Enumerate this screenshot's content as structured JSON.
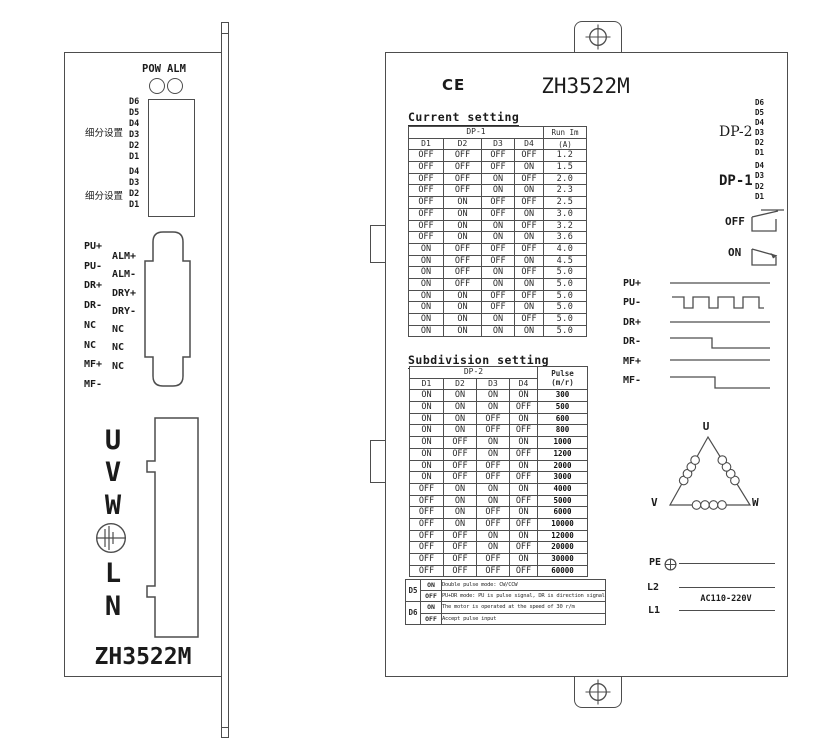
{
  "colors": {
    "line": "#4d4d4d",
    "background": "#ffffff"
  },
  "left_panel": {
    "model": "ZH3522M",
    "led_labels": [
      "POW",
      "ALM"
    ],
    "subdivision_cn": "细分设置",
    "dip1_bits": [
      "D6",
      "D5",
      "D4",
      "D3",
      "D2",
      "D1"
    ],
    "dip2_bits": [
      "D4",
      "D3",
      "D2",
      "D1"
    ],
    "connector_left_pins": [
      "PU+",
      "PU-",
      "DR+",
      "DR-",
      "NC",
      "NC",
      "MF+",
      "MF-"
    ],
    "connector_right_pins": [
      "ALM+",
      "ALM-",
      "DRY+",
      "DRY-",
      "NC",
      "NC",
      "NC"
    ],
    "terminal_labels": [
      "U",
      "V",
      "W",
      "L",
      "N"
    ]
  },
  "right_panel": {
    "ce_mark": "CE",
    "model": "ZH3522M",
    "current_setting": {
      "title": "Current setting",
      "dp_header": "DP-1",
      "bit_columns": [
        "D1",
        "D2",
        "D3",
        "D4"
      ],
      "value_header": [
        "Run Im",
        "(A)"
      ],
      "rows": [
        [
          "OFF",
          "OFF",
          "OFF",
          "OFF",
          "1.2"
        ],
        [
          "OFF",
          "OFF",
          "OFF",
          "ON",
          "1.5"
        ],
        [
          "OFF",
          "OFF",
          "ON",
          "OFF",
          "2.0"
        ],
        [
          "OFF",
          "OFF",
          "ON",
          "ON",
          "2.3"
        ],
        [
          "OFF",
          "ON",
          "OFF",
          "OFF",
          "2.5"
        ],
        [
          "OFF",
          "ON",
          "OFF",
          "ON",
          "3.0"
        ],
        [
          "OFF",
          "ON",
          "ON",
          "OFF",
          "3.2"
        ],
        [
          "OFF",
          "ON",
          "ON",
          "ON",
          "3.6"
        ],
        [
          "ON",
          "OFF",
          "OFF",
          "OFF",
          "4.0"
        ],
        [
          "ON",
          "OFF",
          "OFF",
          "ON",
          "4.5"
        ],
        [
          "ON",
          "OFF",
          "ON",
          "OFF",
          "5.0"
        ],
        [
          "ON",
          "OFF",
          "ON",
          "ON",
          "5.0"
        ],
        [
          "ON",
          "ON",
          "OFF",
          "OFF",
          "5.0"
        ],
        [
          "ON",
          "ON",
          "OFF",
          "ON",
          "5.0"
        ],
        [
          "ON",
          "ON",
          "ON",
          "OFF",
          "5.0"
        ],
        [
          "ON",
          "ON",
          "ON",
          "ON",
          "5.0"
        ]
      ]
    },
    "subdivision_setting": {
      "title": "Subdivision setting",
      "dp_header": "DP-2",
      "bit_columns": [
        "D1",
        "D2",
        "D3",
        "D4"
      ],
      "value_header": [
        "Pulse",
        "(m/r)"
      ],
      "rows": [
        [
          "ON",
          "ON",
          "ON",
          "ON",
          "300"
        ],
        [
          "ON",
          "ON",
          "ON",
          "OFF",
          "500"
        ],
        [
          "ON",
          "ON",
          "OFF",
          "ON",
          "600"
        ],
        [
          "ON",
          "ON",
          "OFF",
          "OFF",
          "800"
        ],
        [
          "ON",
          "OFF",
          "ON",
          "ON",
          "1000"
        ],
        [
          "ON",
          "OFF",
          "ON",
          "OFF",
          "1200"
        ],
        [
          "ON",
          "OFF",
          "OFF",
          "ON",
          "2000"
        ],
        [
          "ON",
          "OFF",
          "OFF",
          "OFF",
          "3000"
        ],
        [
          "OFF",
          "ON",
          "ON",
          "ON",
          "4000"
        ],
        [
          "OFF",
          "ON",
          "ON",
          "OFF",
          "5000"
        ],
        [
          "OFF",
          "ON",
          "OFF",
          "ON",
          "6000"
        ],
        [
          "OFF",
          "ON",
          "OFF",
          "OFF",
          "10000"
        ],
        [
          "OFF",
          "OFF",
          "ON",
          "ON",
          "12000"
        ],
        [
          "OFF",
          "OFF",
          "ON",
          "OFF",
          "20000"
        ],
        [
          "OFF",
          "OFF",
          "OFF",
          "ON",
          "30000"
        ],
        [
          "OFF",
          "OFF",
          "OFF",
          "OFF",
          "60000"
        ]
      ]
    },
    "notes": [
      {
        "bit": "D5",
        "on_label": "ON",
        "off_label": "OFF",
        "on_text": "Double pulse mode: CW/CCW",
        "off_text": "PU+DR mode: PU is pulse signal, DR is direction signal"
      },
      {
        "bit": "D6",
        "on_label": "ON",
        "off_label": "OFF",
        "on_text": "The motor is operated at the speed of 30 r/m",
        "off_text": "Accept pulse input"
      }
    ],
    "dp2_label": "DP-2",
    "dp2_bits": [
      "D6",
      "D5",
      "D4",
      "D3",
      "D2",
      "D1"
    ],
    "dp1_label": "DP-1",
    "dp1_bits": [
      "D4",
      "D3",
      "D2",
      "D1"
    ],
    "switch_positions": [
      "OFF",
      "ON"
    ],
    "signal_labels": [
      "PU+",
      "PU-",
      "DR+",
      "DR-",
      "MF+",
      "MF-"
    ],
    "motor_terminals": {
      "u": "U",
      "v": "V",
      "w": "W"
    },
    "power_labels": {
      "pe": "PE",
      "l2": "L2",
      "l1": "L1",
      "voltage": "AC110-220V"
    }
  }
}
